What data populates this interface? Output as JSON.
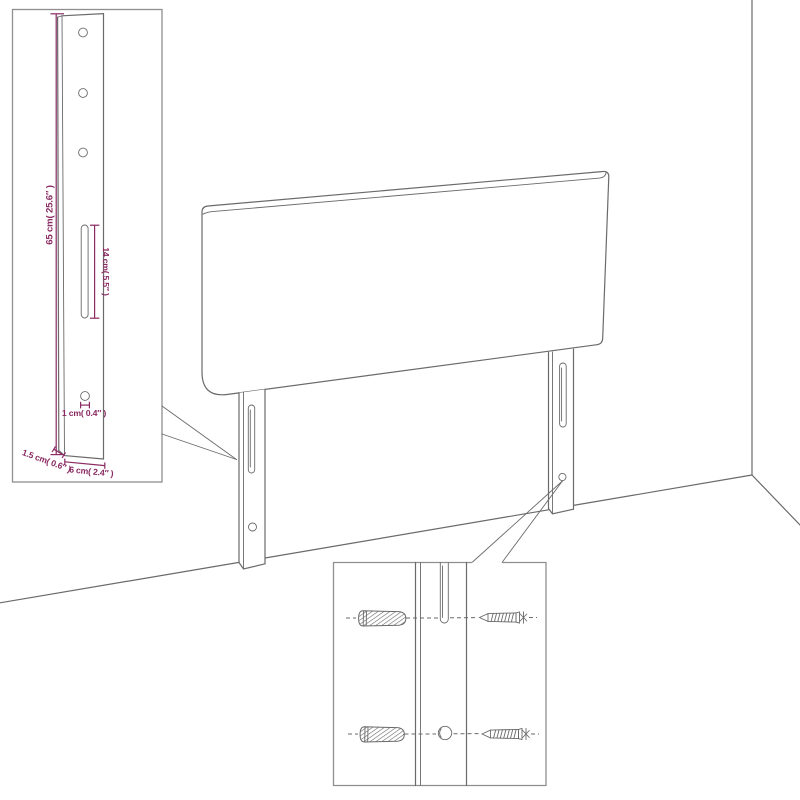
{
  "colors": {
    "background": "#ffffff",
    "line": "#6a6a6a",
    "dimension": "#8a2a62"
  },
  "insets": {
    "leg_detail": {
      "dimensions": {
        "height": "65 cm( 25.6″ )",
        "slot_length": "14 cm( 5.5″ )",
        "hole_diameter": "1 cm( 0.4″ )",
        "thickness": "1.5 cm( 0.6″ )",
        "width": "6 cm( 2.4″ )"
      }
    },
    "mounting_detail": {
      "hardware": [
        "wall-plug-icon",
        "screw-icon",
        "slot-cutout",
        "round-hole"
      ]
    }
  }
}
